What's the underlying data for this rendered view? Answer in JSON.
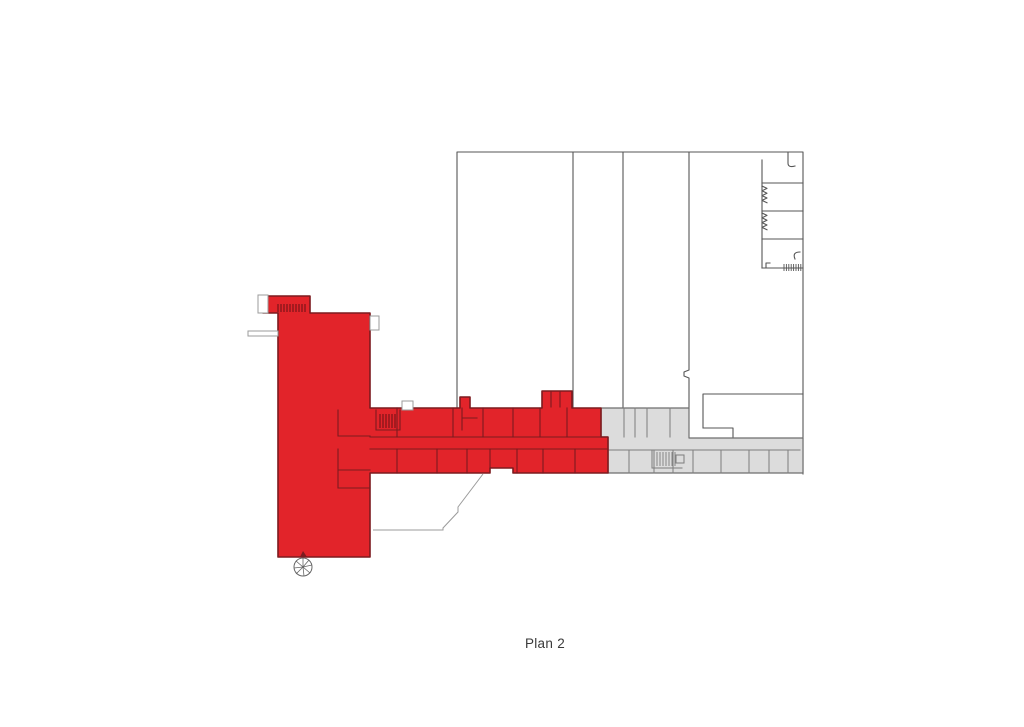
{
  "caption": {
    "label": "Plan 2"
  },
  "colors": {
    "page_background": "#ffffff",
    "highlight_red": "#e2242a",
    "highlight_wall": "#7c1b1f",
    "highlight_hatch": "#5a1012",
    "secondary_gray": "#dcdcdc",
    "secondary_wall": "#7d7d7d",
    "building_wall": "#565656",
    "thin_outline": "#9b9b9b",
    "caption_text": "#3a3a3a"
  },
  "plan": {
    "name": "Plan 2",
    "zones": [
      {
        "id": "highlighted-wing",
        "fill": "#e2242a"
      },
      {
        "id": "secondary-wing",
        "fill": "#dcdcdc"
      },
      {
        "id": "main-building",
        "fill": "#ffffff"
      }
    ]
  }
}
